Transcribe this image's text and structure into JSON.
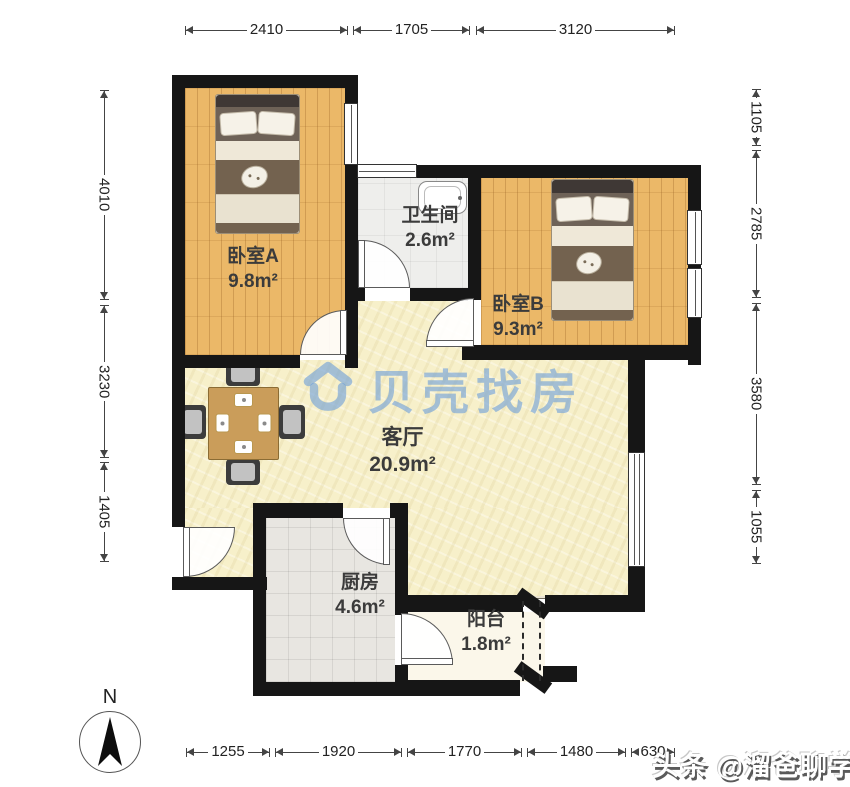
{
  "watermark": {
    "brand": "贝壳找房",
    "brand_color": "#6FA0D8",
    "credit": "头条 @溜爸聊学区"
  },
  "compass": {
    "label": "N"
  },
  "rooms": [
    {
      "id": "bedroomA",
      "name": "卧室A",
      "area": "9.8m²"
    },
    {
      "id": "bathroom",
      "name": "卫生间",
      "area": "2.6m²"
    },
    {
      "id": "bedroomB",
      "name": "卧室B",
      "area": "9.3m²"
    },
    {
      "id": "living",
      "name": "客厅",
      "area": "20.9m²"
    },
    {
      "id": "kitchen",
      "name": "厨房",
      "area": "4.6m²"
    },
    {
      "id": "balcony",
      "name": "阳台",
      "area": "1.8m²"
    }
  ],
  "dimensions_mm": {
    "top": [
      "2410",
      "1705",
      "3120"
    ],
    "left": [
      "4010",
      "3230",
      "1405"
    ],
    "right": [
      "1105",
      "2785",
      "3580",
      "1055"
    ],
    "bottom": [
      "1255",
      "1920",
      "1770",
      "1480",
      "630"
    ]
  },
  "colors": {
    "wall": "#161616",
    "wood_floor": "#EBB868",
    "living_floor": "#F7F0CA",
    "kitchen_floor": "#E8E6E1",
    "bathroom_floor": "#EEEEEC",
    "balcony_floor": "#FBF7EA",
    "dimension_text": "#222222"
  }
}
